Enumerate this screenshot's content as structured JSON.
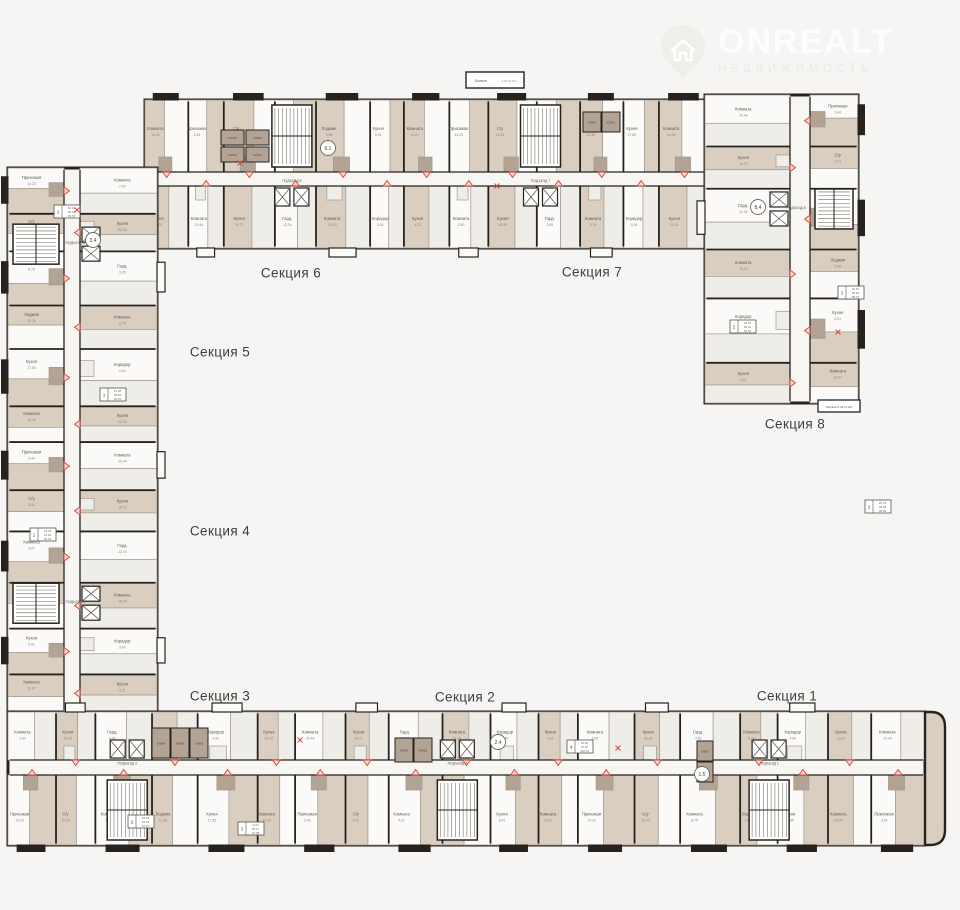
{
  "logo": {
    "title": "ONREALT",
    "subtitle": "НЕДВИЖИМОСТЬ",
    "title_color": "#fdfdfc",
    "subtitle_color": "#ebe9e5",
    "icon_color": "#f0eeeb",
    "icon_house_color": "#ffffff"
  },
  "background": "#f6f5f3",
  "palette": {
    "wall": "#26231f",
    "room_beige": "#d9cec0",
    "room_taupe": "#b3a394",
    "room_white": "#fbfaf8",
    "room_light": "#efede8",
    "corridor": "#f7f6f2",
    "partition": "#a09a91",
    "label": "#5f5b55",
    "label_faint": "#8a857e",
    "accent_red": "#cf4538",
    "accent_red_fill": "#f3d8d3",
    "circle_stroke": "#6b6660"
  },
  "sections": [
    {
      "id": "1",
      "label": "Секция 1",
      "x": 787,
      "y": 696
    },
    {
      "id": "2",
      "label": "Секция 2",
      "x": 465,
      "y": 697
    },
    {
      "id": "3",
      "label": "Секция 3",
      "x": 220,
      "y": 696
    },
    {
      "id": "4",
      "label": "Секция 4",
      "x": 220,
      "y": 531
    },
    {
      "id": "5",
      "label": "Секция 5",
      "x": 220,
      "y": 352
    },
    {
      "id": "6",
      "label": "Секция 6",
      "x": 291,
      "y": 273
    },
    {
      "id": "7",
      "label": "Секция 7",
      "x": 592,
      "y": 272
    },
    {
      "id": "8",
      "label": "Секция 8",
      "x": 795,
      "y": 424
    }
  ],
  "entrance_label": "ПОДЪЕЗД",
  "rooms_vocab": [
    "Комната",
    "Кухня",
    "Прихожая",
    "Комната",
    "С/у",
    "Кухня",
    "Комната",
    "Гард.",
    "Лоджия",
    "Комната",
    "Кухня",
    "Коридор"
  ],
  "area_samples": [
    "10.26",
    "13.02",
    "3.44",
    "20.44",
    "5.41",
    "16.71",
    "4.67",
    "12.24",
    "9.98",
    "15.29",
    "6.91",
    "3.40",
    "11.07",
    "4.21",
    "14.23",
    "2.50",
    "10.43",
    "52.26",
    "8.79",
    "3.95",
    "12.36",
    "5.76",
    "17.85",
    "4.54"
  ],
  "annex": {
    "label": "Балкон",
    "area": "3.07 (3.07)",
    "x": 466,
    "y": 72,
    "w": 58,
    "h": 16
  },
  "right_wing_lodge": {
    "label": "Лоджия",
    "area": "3.02 (4.04)"
  },
  "entrance_circles": [
    {
      "label": "6.1",
      "x": 328,
      "y": 148
    },
    {
      "label": "3.4",
      "x": 93,
      "y": 240
    },
    {
      "label": "8.4",
      "x": 758,
      "y": 207
    },
    {
      "label": "2.4",
      "x": 498,
      "y": 742
    },
    {
      "label": "1.5",
      "x": 702,
      "y": 774
    }
  ],
  "storage_cells": [
    {
      "label": "КЛ/05",
      "x": 221,
      "y": 130,
      "w": 23,
      "h": 15
    },
    {
      "label": "КЛ/03",
      "x": 221,
      "y": 147,
      "w": 23,
      "h": 15
    },
    {
      "label": "КЛ/06",
      "x": 246,
      "y": 130,
      "w": 23,
      "h": 15
    },
    {
      "label": "КЛ/04",
      "x": 246,
      "y": 147,
      "w": 23,
      "h": 15
    },
    {
      "label": "КЛ/01",
      "x": 583,
      "y": 112,
      "w": 18,
      "h": 20
    },
    {
      "label": "КЛ/02",
      "x": 602,
      "y": 112,
      "w": 18,
      "h": 20
    },
    {
      "label": "КЛ/04",
      "x": 152,
      "y": 728,
      "w": 18,
      "h": 30
    },
    {
      "label": "КЛ/05",
      "x": 171,
      "y": 728,
      "w": 18,
      "h": 30
    },
    {
      "label": "КЛ/06",
      "x": 190,
      "y": 728,
      "w": 18,
      "h": 30
    },
    {
      "label": "КЛ/02",
      "x": 395,
      "y": 738,
      "w": 18,
      "h": 24
    },
    {
      "label": "КЛ/03",
      "x": 414,
      "y": 738,
      "w": 18,
      "h": 24
    },
    {
      "label": "КЛ/07",
      "x": 697,
      "y": 741,
      "w": 16,
      "h": 20
    },
    {
      "label": "КЛ/08",
      "x": 697,
      "y": 762,
      "w": 16,
      "h": 20
    }
  ],
  "unit_specs": [
    {
      "x": 54,
      "y": 205,
      "rooms": "1",
      "areas": [
        "16.41",
        "38.07",
        "39.78"
      ]
    },
    {
      "x": 100,
      "y": 388,
      "rooms": "1",
      "areas": [
        "15.28",
        "38.40",
        "40.02"
      ]
    },
    {
      "x": 30,
      "y": 528,
      "rooms": "1",
      "areas": [
        "15.34",
        "43.40",
        "45.03"
      ]
    },
    {
      "x": 838,
      "y": 286,
      "rooms": "1",
      "areas": [
        "16.51",
        "56.84",
        "58.97"
      ]
    },
    {
      "x": 730,
      "y": 320,
      "rooms": "2",
      "areas": [
        "31.21",
        "60.01",
        "64.79"
      ]
    },
    {
      "x": 567,
      "y": 740,
      "rooms": "4",
      "areas": [
        "70.60",
        "97.97",
        "106.70"
      ]
    },
    {
      "x": 128,
      "y": 815,
      "rooms": "2",
      "areas": [
        "34.33",
        "64.29",
        "67.07"
      ]
    },
    {
      "x": 238,
      "y": 822,
      "rooms": "1",
      "areas": [
        "9.32",
        "40.17",
        "42.48"
      ]
    },
    {
      "x": 865,
      "y": 500,
      "rooms": "2",
      "areas": [
        "25.79",
        "48.99",
        "48.99"
      ]
    }
  ],
  "door_crosses": [
    [
      240,
      163
    ],
    [
      497,
      186
    ],
    [
      77,
      210
    ],
    [
      618,
      748
    ],
    [
      838,
      332
    ],
    [
      300,
      740
    ]
  ],
  "plan": {
    "unit_width_pattern": [
      1,
      0.82,
      1.18,
      0.95,
      1.25,
      0.78,
      1.05,
      0.9,
      1.12,
      1
    ],
    "room_color_sequence": [
      "room_beige",
      "room_white",
      "room_beige",
      "room_light",
      "room_white",
      "room_beige",
      "room_white",
      "room_light"
    ],
    "wings": [
      {
        "name": "sections-6-7-top-bar",
        "side": "top",
        "x": 145,
        "y": 100,
        "len": 565,
        "across": 148,
        "outer": 72,
        "corridor": 14,
        "units": 13,
        "cores": [
          {
            "at": 0.26,
            "num": "6"
          },
          {
            "at": 0.7,
            "num": "7"
          }
        ]
      },
      {
        "name": "section-8-right-wing",
        "side": "right",
        "x": 705,
        "y": 95,
        "len": 308,
        "across": 153,
        "outer": 48,
        "corridor": 20,
        "units": 6,
        "cores": [
          {
            "at": 0.37,
            "num": "8"
          }
        ]
      },
      {
        "name": "sections-4-5-left-wing",
        "side": "left",
        "x": 8,
        "y": 168,
        "len": 544,
        "across": 149,
        "outer": 56,
        "corridor": 16,
        "units": 12,
        "cores": [
          {
            "at": 0.14,
            "num": "5"
          },
          {
            "at": 0.8,
            "num": "4"
          }
        ]
      },
      {
        "name": "sections-1-2-3-bottom-bar",
        "side": "bottom",
        "x": 8,
        "y": 712,
        "len": 917,
        "across": 133,
        "outer": 70,
        "corridor": 15,
        "units": 19,
        "cores": [
          {
            "at": 0.13,
            "num": "3"
          },
          {
            "at": 0.49,
            "num": "2"
          },
          {
            "at": 0.83,
            "num": "1"
          }
        ]
      }
    ]
  }
}
